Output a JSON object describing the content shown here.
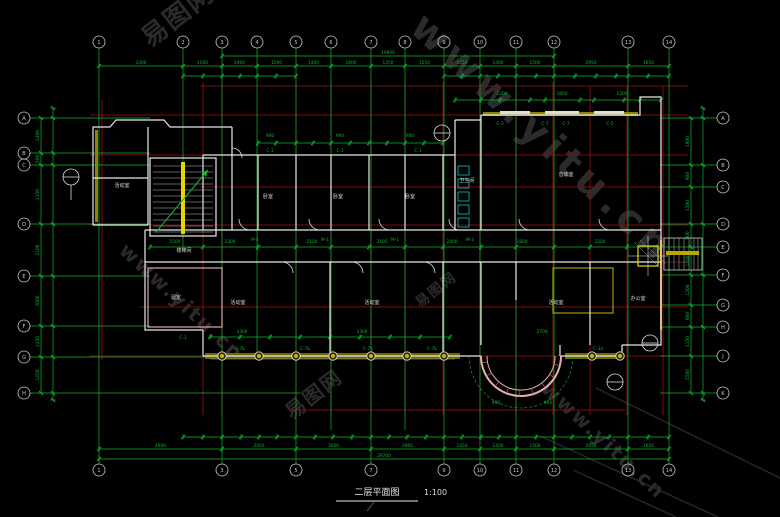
{
  "drawing": {
    "title": "二层平面图",
    "scale": "1:100"
  },
  "colors": {
    "green": "#10b431",
    "red": "#7c0e0e",
    "wall": "#e8e8e8",
    "pink": "#dca8a8",
    "yellow": "#c8b800",
    "cyan": "#00c8c8",
    "watermark": "#2b2b2b",
    "bubble": "#c8c8c8"
  },
  "watermarks": [
    {
      "text": "易图网",
      "x": 150,
      "y": 48,
      "rot": -38,
      "size": 26
    },
    {
      "text": "www.yitu.cn",
      "x": 408,
      "y": 30,
      "rot": 43,
      "size": 40
    },
    {
      "text": "www.yitu.cn",
      "x": 118,
      "y": 252,
      "rot": 43,
      "size": 20
    },
    {
      "text": "易图网",
      "x": 292,
      "y": 420,
      "rot": -38,
      "size": 20
    },
    {
      "text": "www.yitu.cn",
      "x": 540,
      "y": 390,
      "rot": 43,
      "size": 20
    },
    {
      "text": "易图网",
      "x": 420,
      "y": 308,
      "rot": -38,
      "size": 14
    }
  ],
  "axes": [
    {
      "side": "top",
      "fixed": 42,
      "coords": [
        99,
        183,
        222,
        257,
        296,
        331,
        371,
        405,
        444,
        480,
        516,
        554,
        628,
        669
      ],
      "labels": [
        "1",
        "2",
        "3",
        "4",
        "5",
        "6",
        "7",
        "8",
        "9",
        "10",
        "11",
        "12",
        "13",
        "14"
      ]
    },
    {
      "side": "bottom",
      "fixed": 470,
      "coords": [
        99,
        222,
        296,
        371,
        444,
        480,
        516,
        554,
        628,
        669
      ],
      "labels": [
        "1",
        "3",
        "5",
        "7",
        "9",
        "10",
        "11",
        "12",
        "13",
        "14"
      ]
    },
    {
      "side": "left",
      "fixed": 24,
      "coords": [
        118,
        153,
        165,
        224,
        276,
        326,
        357,
        393
      ],
      "labels": [
        "A",
        "B",
        "C",
        "D",
        "E",
        "F",
        "G",
        "H"
      ]
    },
    {
      "side": "right",
      "fixed": 723,
      "coords": [
        118,
        165,
        187,
        224,
        247,
        275,
        305,
        327,
        356,
        393
      ],
      "labels": [
        "A",
        "B",
        "C",
        "D",
        "E",
        "F",
        "G",
        "H",
        "J",
        "K"
      ]
    }
  ],
  "dim_chains": [
    {
      "id": "top-total",
      "orient": "h",
      "pos": 56,
      "ticks": [
        222,
        554
      ],
      "labels": [
        "19800"
      ]
    },
    {
      "id": "top-major",
      "orient": "h",
      "pos": 66,
      "ticks": [
        99,
        183,
        222,
        257,
        296,
        331,
        371,
        405,
        444,
        480,
        516,
        554,
        628,
        669
      ],
      "labels": [
        "3300",
        "1500",
        "1400",
        "1500",
        "1400",
        "1600",
        "1350",
        "1550",
        "1450",
        "1400",
        "1500",
        "2950",
        "1650"
      ]
    },
    {
      "id": "top-minor-l",
      "orient": "h",
      "pos": 76,
      "ticks": [
        183,
        203,
        222,
        240,
        257,
        276,
        296
      ],
      "labels": []
    },
    {
      "id": "top-minor-r",
      "orient": "h",
      "pos": 76,
      "ticks": [
        444,
        462,
        480,
        498,
        516,
        536,
        554,
        575,
        596,
        616,
        628,
        648,
        669
      ],
      "labels": []
    },
    {
      "id": "rw-windows",
      "orient": "h",
      "pos": 100,
      "ticks": [
        455,
        481,
        500,
        530,
        545,
        580,
        594,
        624,
        640,
        661
      ],
      "labels": []
    },
    {
      "id": "bottom-minor",
      "orient": "h",
      "pos": 437,
      "ticks": [
        183,
        203,
        222,
        241,
        259,
        277,
        296,
        315,
        333,
        352,
        371,
        389,
        407,
        426,
        444,
        462,
        481,
        499,
        516,
        536,
        554,
        572,
        590,
        609,
        628,
        648,
        669
      ],
      "labels": []
    },
    {
      "id": "bottom-major",
      "orient": "h",
      "pos": 449,
      "ticks": [
        99,
        222,
        296,
        371,
        444,
        480,
        516,
        554,
        628,
        669
      ],
      "labels": [
        "4900",
        "2950",
        "3000",
        "2900",
        "1450",
        "1400",
        "1500",
        "2950",
        "1650"
      ]
    },
    {
      "id": "bottom-total",
      "orient": "h",
      "pos": 459,
      "ticks": [
        99,
        669
      ],
      "labels": [
        "29700"
      ]
    },
    {
      "id": "left-outer",
      "orient": "v",
      "pos": 41,
      "ticks": [
        118,
        153,
        165,
        224,
        276,
        326,
        357,
        393
      ],
      "labels": [
        "1400",
        "500",
        "2350",
        "2100",
        "2000",
        "1250",
        "1450"
      ]
    },
    {
      "id": "left-inner",
      "orient": "v",
      "pos": 53,
      "ticks": [
        108,
        118,
        153,
        165,
        224,
        276,
        326,
        357,
        393,
        400
      ],
      "labels": []
    },
    {
      "id": "right-outer",
      "orient": "v",
      "pos": 691,
      "ticks": [
        118,
        165,
        187,
        224,
        247,
        275,
        305,
        327,
        356,
        393
      ],
      "labels": [
        "1900",
        "900",
        "1500",
        "900",
        "1100",
        "1200",
        "900",
        "1150",
        "1500"
      ]
    },
    {
      "id": "right-inner",
      "orient": "v",
      "pos": 703,
      "ticks": [
        108,
        118,
        165,
        224,
        275,
        327,
        393,
        400
      ],
      "labels": []
    },
    {
      "id": "corridor",
      "orient": "h",
      "pos": 247,
      "ticks": [
        150,
        203,
        258,
        296,
        331,
        369,
        405,
        443,
        481,
        516,
        554,
        590,
        627,
        661
      ],
      "labels": []
    },
    {
      "id": "midband",
      "orient": "h",
      "pos": 143,
      "ticks": [
        258,
        276,
        296,
        313,
        331,
        350,
        369,
        387,
        405,
        424,
        443
      ],
      "labels": []
    },
    {
      "id": "lowerband",
      "orient": "h",
      "pos": 337,
      "ticks": [
        210,
        240,
        270,
        300,
        330,
        360,
        390,
        420,
        450
      ],
      "labels": []
    }
  ],
  "scatter_dims": [
    {
      "x": 175,
      "y": 243,
      "t": "1500"
    },
    {
      "x": 230,
      "y": 243,
      "t": "3300"
    },
    {
      "x": 312,
      "y": 243,
      "t": "2100"
    },
    {
      "x": 382,
      "y": 243,
      "t": "2100"
    },
    {
      "x": 452,
      "y": 243,
      "t": "2400"
    },
    {
      "x": 522,
      "y": 243,
      "t": "1800"
    },
    {
      "x": 600,
      "y": 243,
      "t": "3300"
    },
    {
      "x": 270,
      "y": 137,
      "t": "900"
    },
    {
      "x": 340,
      "y": 137,
      "t": "900"
    },
    {
      "x": 410,
      "y": 137,
      "t": "900"
    },
    {
      "x": 502,
      "y": 95,
      "t": "1200"
    },
    {
      "x": 562,
      "y": 95,
      "t": "1800"
    },
    {
      "x": 622,
      "y": 95,
      "t": "1200"
    },
    {
      "x": 242,
      "y": 333,
      "t": "3300"
    },
    {
      "x": 362,
      "y": 333,
      "t": "3300"
    },
    {
      "x": 542,
      "y": 333,
      "t": "2700"
    },
    {
      "x": 496,
      "y": 404,
      "t": "900"
    },
    {
      "x": 548,
      "y": 404,
      "t": "900"
    }
  ],
  "room_labels": [
    {
      "x": 122,
      "y": 187,
      "t": "活动室"
    },
    {
      "x": 184,
      "y": 252,
      "t": "楼梯间"
    },
    {
      "x": 176,
      "y": 299,
      "t": "寝室"
    },
    {
      "x": 268,
      "y": 198,
      "t": "卧室"
    },
    {
      "x": 338,
      "y": 198,
      "t": "卧室"
    },
    {
      "x": 410,
      "y": 198,
      "t": "卧室"
    },
    {
      "x": 467,
      "y": 182,
      "t": "卫生间"
    },
    {
      "x": 566,
      "y": 176,
      "t": "音体室"
    },
    {
      "x": 238,
      "y": 304,
      "t": "活动室"
    },
    {
      "x": 372,
      "y": 304,
      "t": "活动室"
    },
    {
      "x": 556,
      "y": 304,
      "t": "活动室"
    },
    {
      "x": 638,
      "y": 300,
      "t": "办公室"
    }
  ],
  "tags": [
    {
      "x": 270,
      "y": 152,
      "t": "C-1"
    },
    {
      "x": 340,
      "y": 152,
      "t": "C-1"
    },
    {
      "x": 418,
      "y": 152,
      "t": "C-1"
    },
    {
      "x": 500,
      "y": 125,
      "t": "C-3"
    },
    {
      "x": 545,
      "y": 125,
      "t": "C-7"
    },
    {
      "x": 566,
      "y": 125,
      "t": "C-7"
    },
    {
      "x": 610,
      "y": 125,
      "t": "C-5"
    },
    {
      "x": 240,
      "y": 350,
      "t": "C-7b"
    },
    {
      "x": 305,
      "y": 350,
      "t": "C-7b"
    },
    {
      "x": 368,
      "y": 350,
      "t": "C-7b"
    },
    {
      "x": 432,
      "y": 350,
      "t": "C-7b"
    },
    {
      "x": 183,
      "y": 339,
      "t": "C-1"
    },
    {
      "x": 598,
      "y": 350,
      "t": "C-3a"
    },
    {
      "x": 255,
      "y": 241,
      "t": "M-1"
    },
    {
      "x": 325,
      "y": 241,
      "t": "M-1"
    },
    {
      "x": 395,
      "y": 241,
      "t": "M-1"
    },
    {
      "x": 470,
      "y": 241,
      "t": "M-2"
    }
  ],
  "columns": {
    "y": 356,
    "xs": [
      222,
      259,
      296,
      333,
      371,
      407,
      444,
      592,
      620
    ]
  }
}
